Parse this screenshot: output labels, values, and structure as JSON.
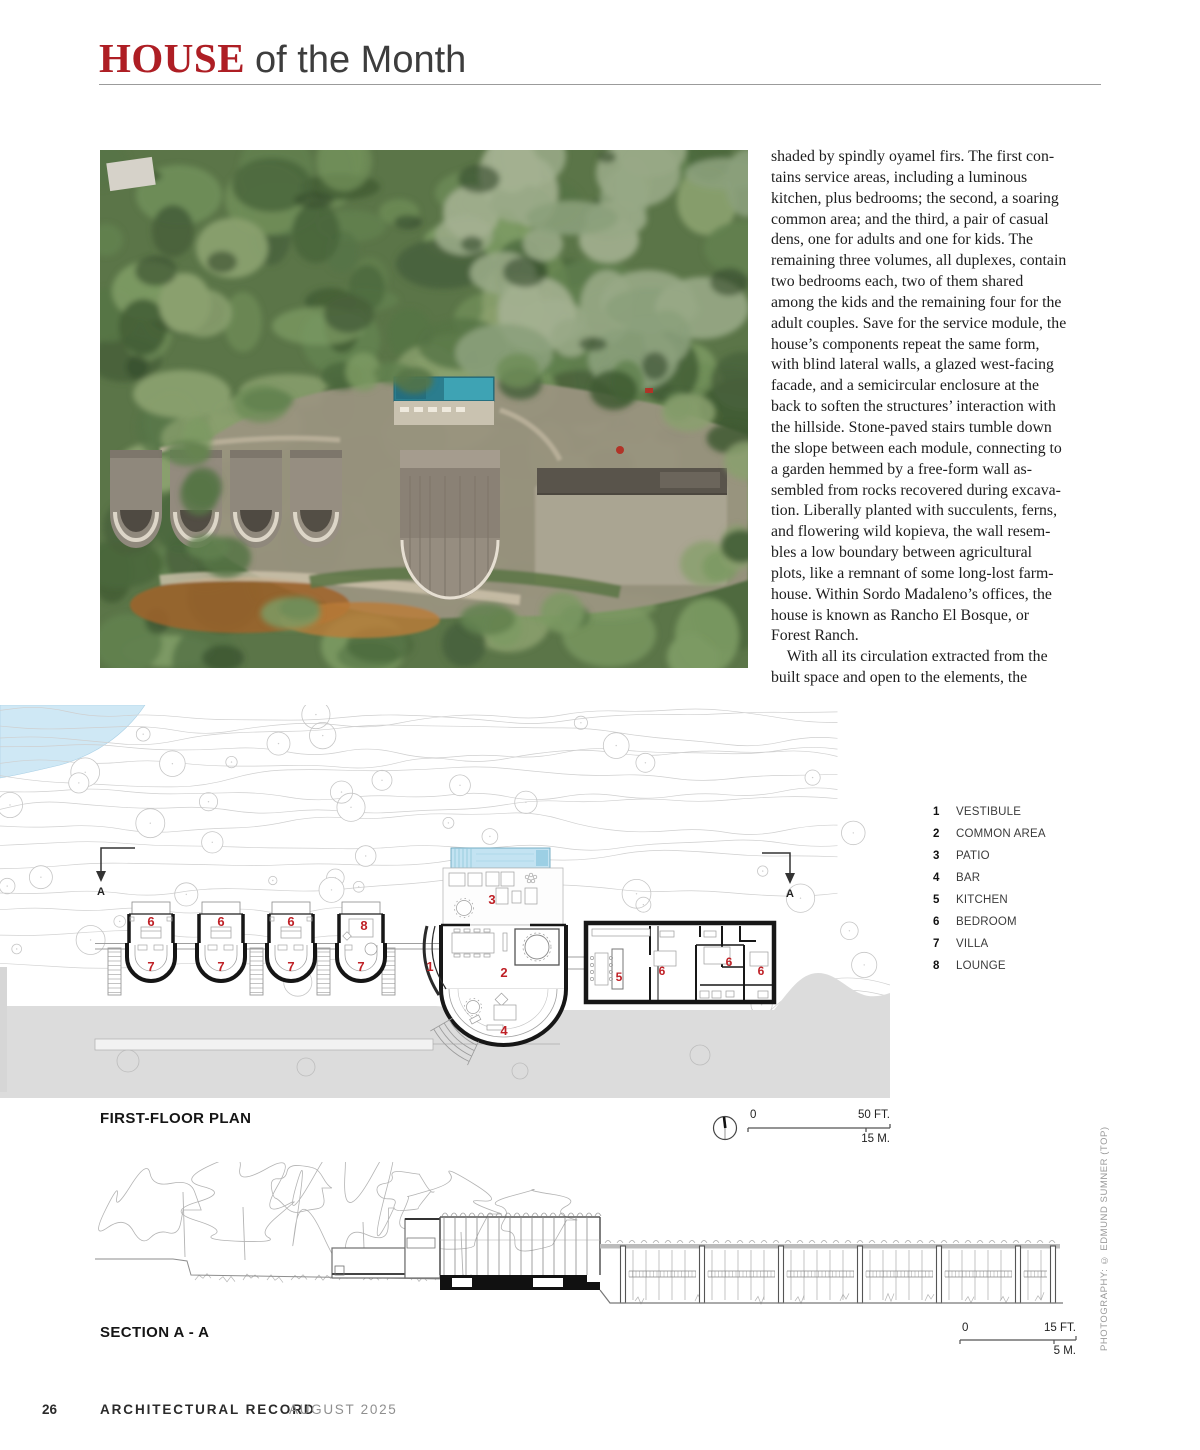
{
  "header": {
    "title_red": "HOUSE",
    "title_rest": "of the Month"
  },
  "article": {
    "column_text": "shaded by spindly oyamel firs. The first con-\ntains service areas, including a luminous\nkitchen, plus bedrooms; the second, a soaring\ncommon area; and the third, a pair of casual\ndens, one for adults and one for kids. The\nremaining three volumes, all duplexes, contain\ntwo bedrooms each, two of them shared\namong the kids and the remaining four for the\nadult couples. Save for the service module, the\nhouse’s components repeat the same form,\nwith blind lateral walls, a glazed west-facing\nfacade, and a semicircular enclosure at the\nback to soften the structures’ interaction with\nthe hillside. Stone-paved stairs tumble down\nthe slope between each module, connecting to\na garden hemmed by a free-form wall as-\nsembled from rocks recovered during excava-\ntion. Liberally planted with succulents, ferns,\nand flowering wild kopieva, the wall resem-\nbles a low boundary between agricultural\nplots, like a remnant of some long-lost farm-\nhouse. Within Sordo Madaleno’s offices, the\nhouse is known as Rancho El Bosque, or\nForest Ranch.\n With all its circulation extracted from the\nbuilt space and open to the elements, the"
  },
  "photo": {
    "credit_vertical": "PHOTOGRAPHY: © EDMUND SUMNER (TOP)"
  },
  "plan": {
    "caption": "FIRST-FLOOR PLAN",
    "scale": {
      "zero": "0",
      "feet": "50 FT.",
      "meters": "15 M."
    },
    "section_marker": "A",
    "legend": [
      {
        "num": "1",
        "label": "VESTIBULE"
      },
      {
        "num": "2",
        "label": "COMMON AREA"
      },
      {
        "num": "3",
        "label": "PATIO"
      },
      {
        "num": "4",
        "label": "BAR"
      },
      {
        "num": "5",
        "label": "KITCHEN"
      },
      {
        "num": "6",
        "label": "BEDROOM"
      },
      {
        "num": "7",
        "label": "VILLA"
      },
      {
        "num": "8",
        "label": "LOUNGE"
      }
    ],
    "room_numbers": {
      "vestibule": "1",
      "common": "2",
      "patio": "3",
      "bar": "4",
      "kitchen": "5",
      "bedroom": "6",
      "villa": "7",
      "lounge": "8"
    }
  },
  "section": {
    "caption": "SECTION A - A",
    "scale": {
      "zero": "0",
      "feet": "15 FT.",
      "meters": "5 M."
    }
  },
  "footer": {
    "page_number": "26",
    "magazine": "ARCHITECTURAL RECORD",
    "issue": "AUGUST 2025"
  }
}
